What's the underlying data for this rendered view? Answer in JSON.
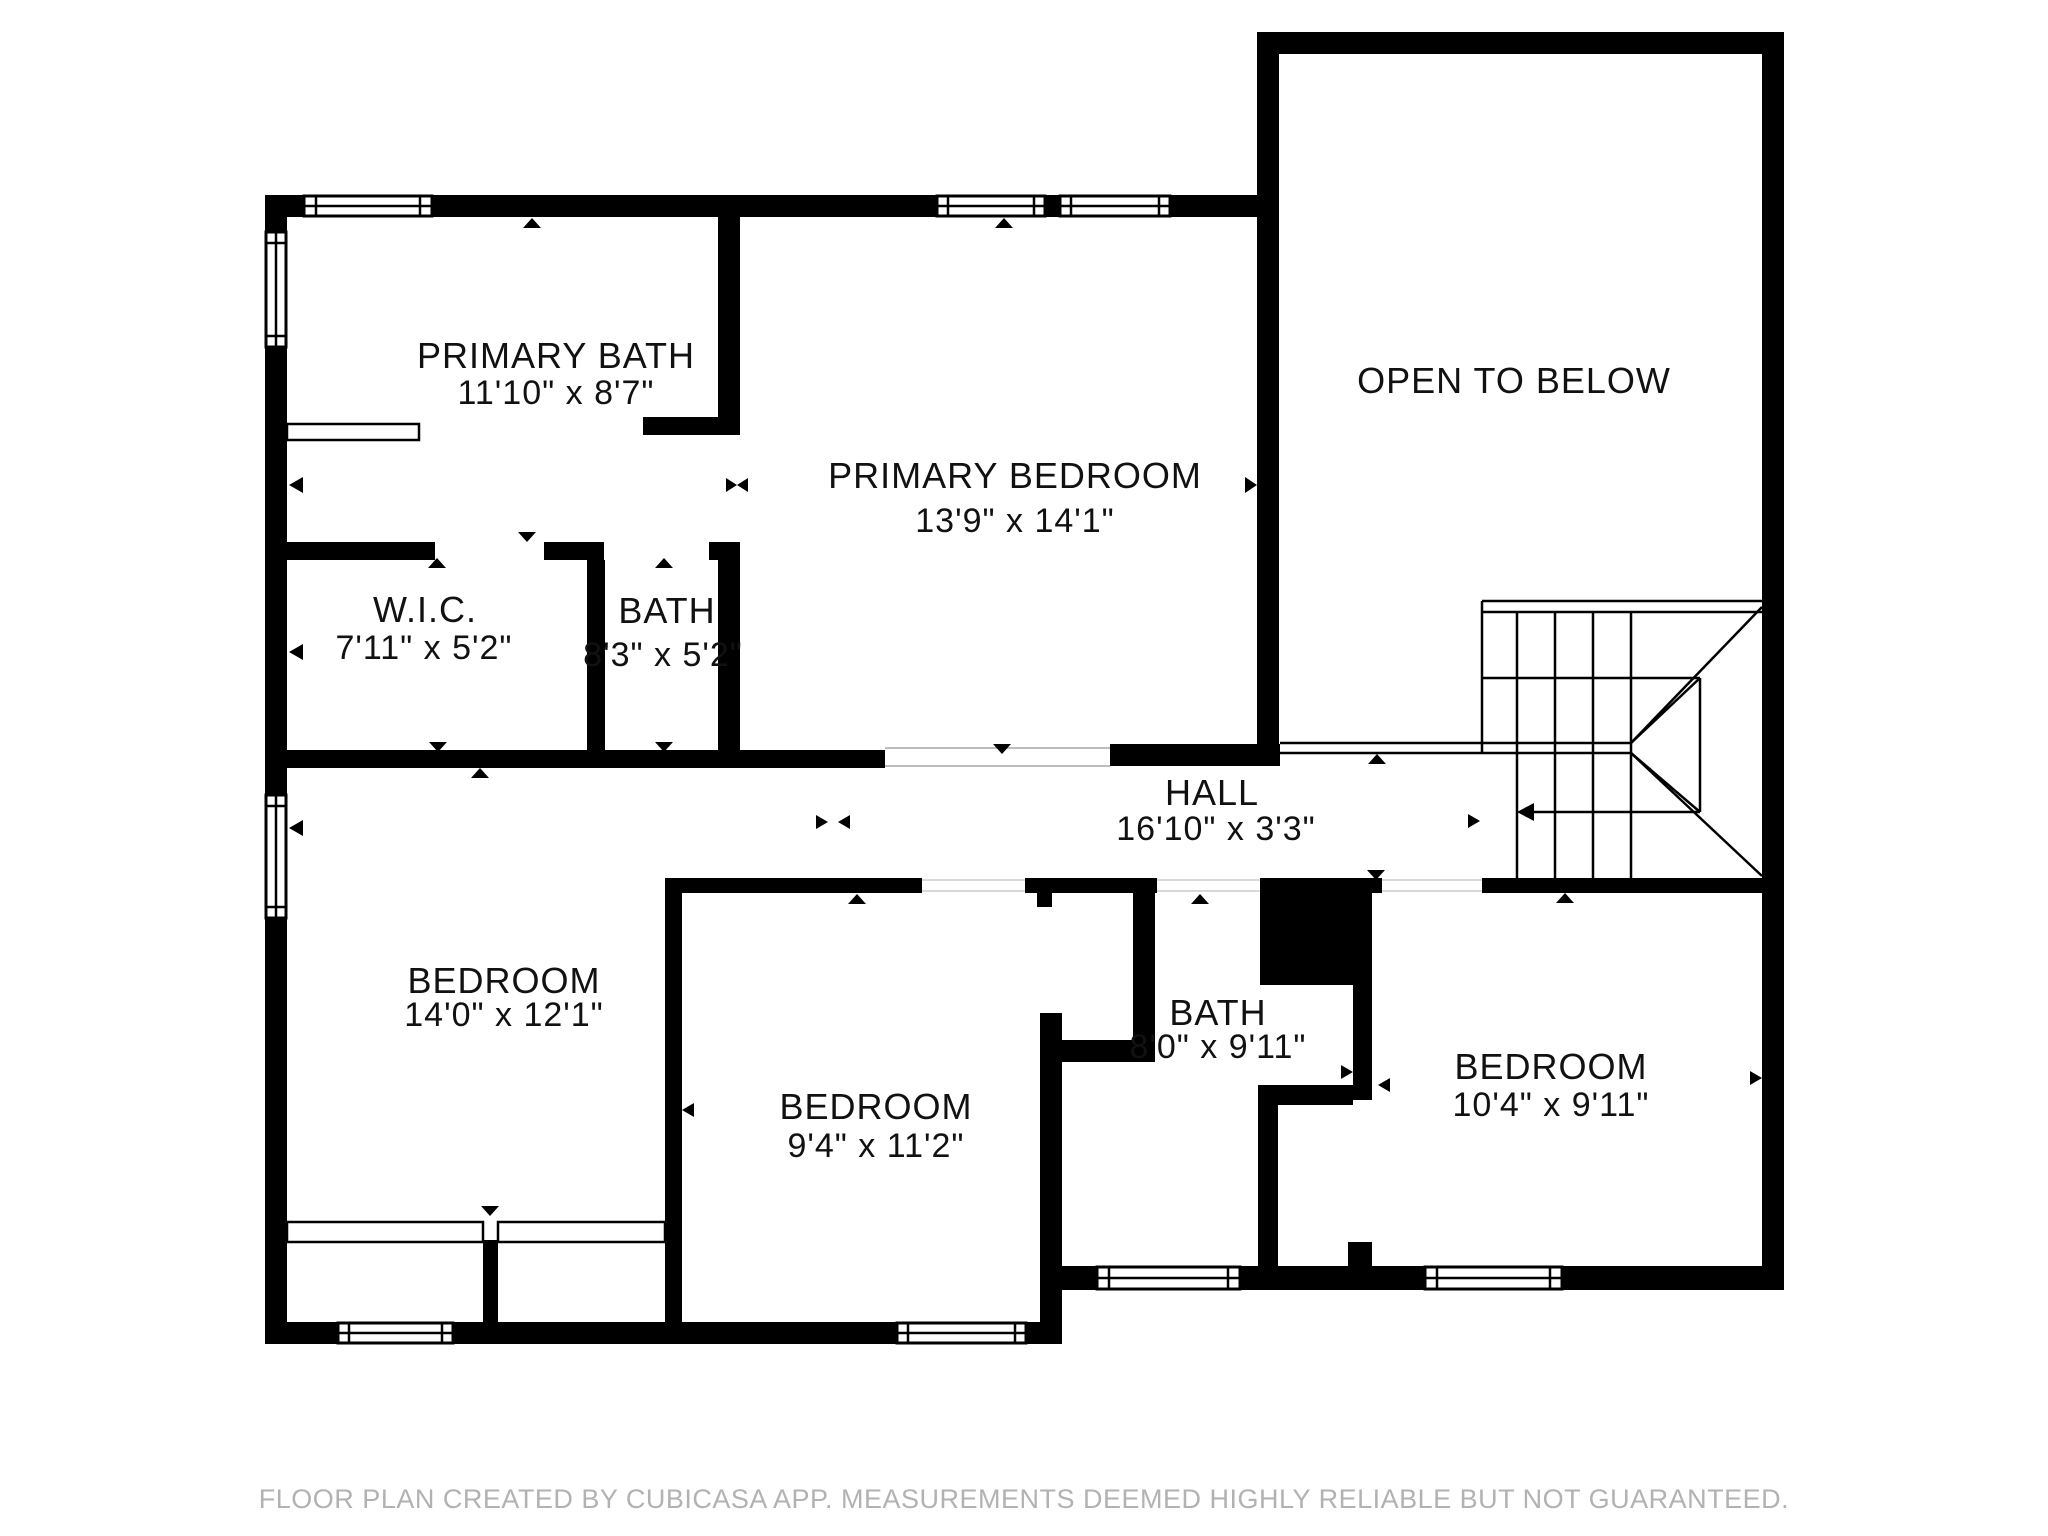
{
  "plan": {
    "rooms": [
      {
        "id": "primary-bath",
        "name": "PRIMARY BATH",
        "dims": "11'10\" x 8'7\""
      },
      {
        "id": "primary-bedroom",
        "name": "PRIMARY BEDROOM",
        "dims": "13'9\" x 14'1\""
      },
      {
        "id": "open-to-below",
        "name": "OPEN TO BELOW",
        "dims": ""
      },
      {
        "id": "wic",
        "name": "W.I.C.",
        "dims": "7'11\" x 5'2\""
      },
      {
        "id": "bath-upper",
        "name": "BATH",
        "dims": "8'3\" x 5'2\""
      },
      {
        "id": "hall",
        "name": "HALL",
        "dims": "16'10\" x 3'3\""
      },
      {
        "id": "bedroom-left",
        "name": "BEDROOM",
        "dims": "14'0\" x 12'1\""
      },
      {
        "id": "bedroom-middle",
        "name": "BEDROOM",
        "dims": "9'4\" x 11'2\""
      },
      {
        "id": "bath-lower",
        "name": "BATH",
        "dims": "8'0\" x 9'11\""
      },
      {
        "id": "bedroom-right",
        "name": "BEDROOM",
        "dims": "10'4\" x 9'11\""
      }
    ],
    "footer": "FLOOR PLAN CREATED BY CUBICASA APP. MEASUREMENTS DEEMED HIGHLY RELIABLE BUT NOT GUARANTEED.",
    "colors": {
      "wall": "#000000",
      "background": "#ffffff",
      "label_text": "#111111",
      "footer_text": "#b2b2b2",
      "door_line": "#bdbdbd"
    }
  }
}
